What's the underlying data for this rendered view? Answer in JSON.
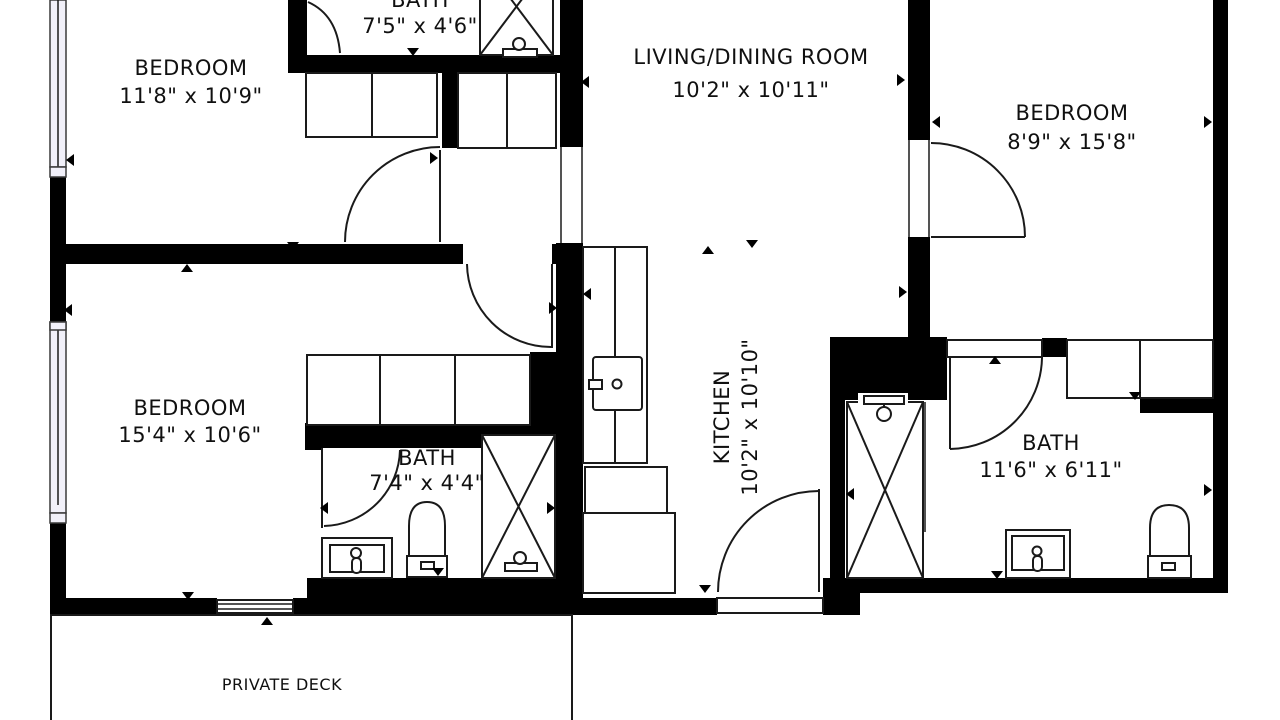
{
  "plan": {
    "type": "floor-plan",
    "rooms": [
      {
        "id": "bedroom-top-left",
        "name": "BEDROOM",
        "dims": "11'8\" x 10'9\""
      },
      {
        "id": "bath-top",
        "name": "BATH",
        "dims": "7'5\" x 4'6\""
      },
      {
        "id": "living-dining",
        "name": "LIVING/DINING ROOM",
        "dims": "10'2\" x 10'11\""
      },
      {
        "id": "bedroom-right",
        "name": "BEDROOM",
        "dims": "8'9\" x 15'8\""
      },
      {
        "id": "bedroom-mid-left",
        "name": "BEDROOM",
        "dims": "15'4\" x 10'6\""
      },
      {
        "id": "bath-middle",
        "name": "BATH",
        "dims": "7'4\" x 4'4\""
      },
      {
        "id": "kitchen",
        "name": "KITCHEN",
        "dims": "10'2\" x 10'10\""
      },
      {
        "id": "bath-right",
        "name": "BATH",
        "dims": "11'6\" x 6'11\""
      },
      {
        "id": "private-deck",
        "name": "PRIVATE DECK",
        "dims": ""
      }
    ],
    "colors": {
      "wall": "#000000",
      "background": "#ffffff",
      "line": "#1a1a1a",
      "window": "#f1f0f9"
    }
  }
}
